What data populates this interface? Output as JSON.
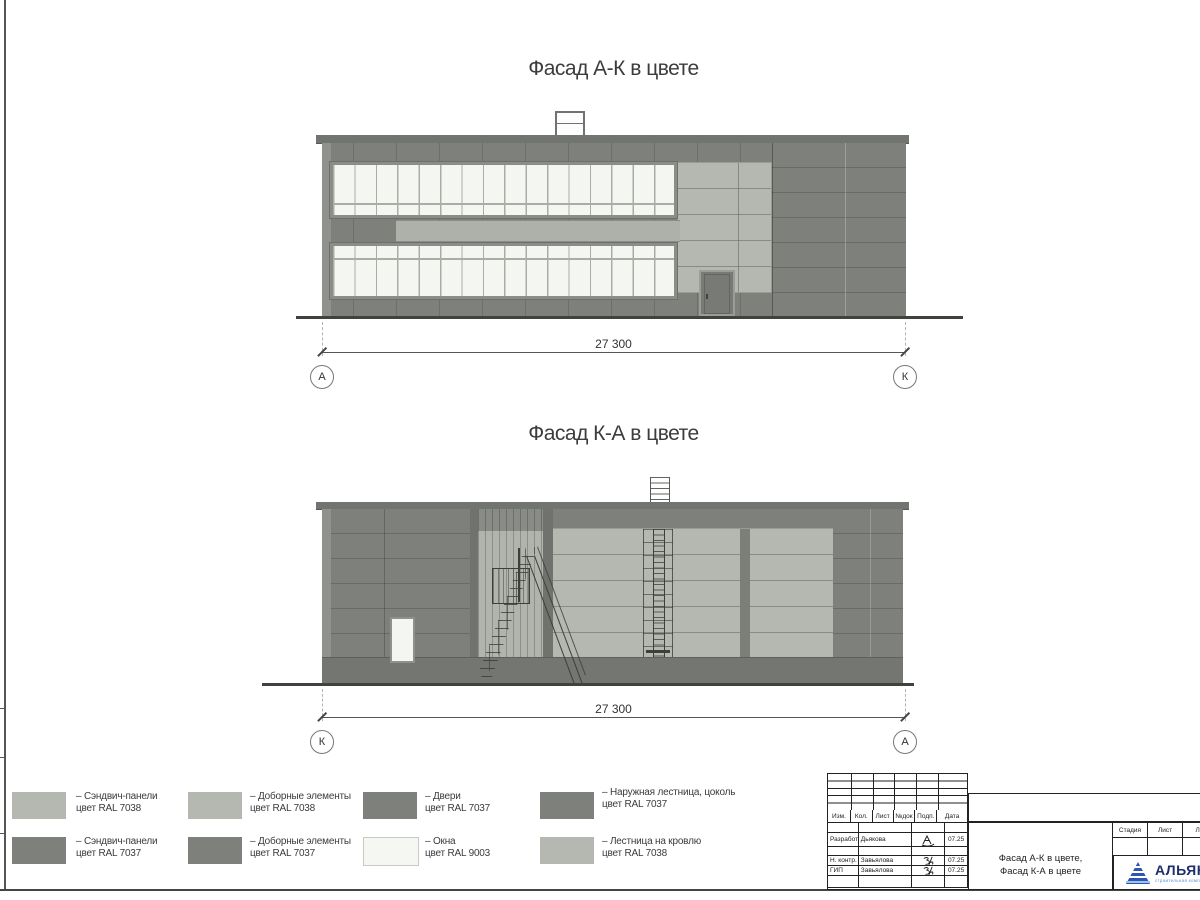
{
  "facade_top": {
    "title": "Фасад А-К в цвете",
    "dimension": "27 300",
    "axis_left": "А",
    "axis_right": "К"
  },
  "facade_bottom": {
    "title": "Фасад К-А в цвете",
    "dimension": "27 300",
    "axis_left": "К",
    "axis_right": "А"
  },
  "legend": [
    {
      "color": "#b5b8b1",
      "line1": "– Сэндвич-панели",
      "line2": "цвет RAL 7038"
    },
    {
      "color": "#7d807b",
      "line1": "– Сэндвич-панели",
      "line2": "цвет RAL 7037"
    },
    {
      "color": "#b5b8b1",
      "line1": "– Доборные элементы",
      "line2": "цвет RAL 7038"
    },
    {
      "color": "#7d807b",
      "line1": "– Доборные элементы",
      "line2": "цвет RAL 7037"
    },
    {
      "color": "#7d807b",
      "line1": "– Двери",
      "line2": "цвет RAL 7037"
    },
    {
      "color": "#f4f7f2",
      "line1": "– Окна",
      "line2": "цвет RAL 9003"
    },
    {
      "color": "#7d807b",
      "line1": "– Наружная лестница, цоколь",
      "line2": "цвет RAL 7037"
    },
    {
      "color": "#b5b8b1",
      "line1": "– Лестница на кровлю",
      "line2": "цвет RAL 7038"
    }
  ],
  "title_block": {
    "change_header": [
      "Изм.",
      "Кол.",
      "Лист",
      "№док",
      "Подп.",
      "Дата"
    ],
    "signature_rows": [
      {
        "role": "Разработал",
        "name": "Дьякова",
        "date": "07.25"
      },
      {
        "role": "Н. контр.",
        "name": "Завьялова",
        "date": "07.25"
      },
      {
        "role": "ГИП",
        "name": "Завьялова",
        "date": "07.25"
      }
    ],
    "doc_title_line1": "Фасад А-К в цвете,",
    "doc_title_line2": "Фасад К-А в цвете",
    "stage_header": [
      "Стадия",
      "Лист",
      "Листов"
    ],
    "company_name": "АЛЬЯНС",
    "company_subtitle": "строительная компания"
  },
  "colors": {
    "panel_dark": "#7d807b",
    "panel_light": "#b5b8b1",
    "window": "#f3f6f1",
    "ral7037": "#7d807b",
    "ral7038": "#b5b8b1",
    "ral9003": "#f4f7f2",
    "logo_text": "#1c2f6b",
    "logo_sub": "#5b8fd4"
  }
}
